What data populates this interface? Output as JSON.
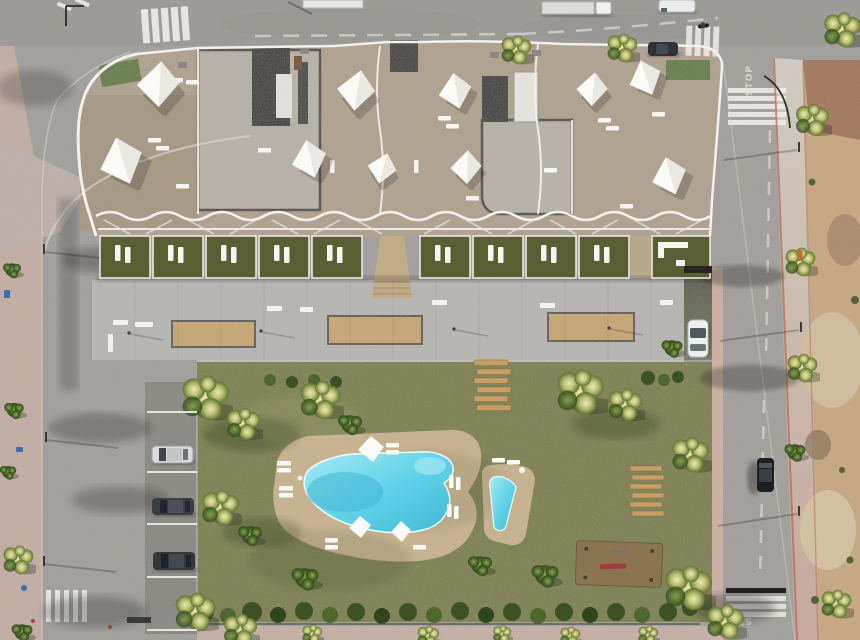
{
  "scene": {
    "type": "aerial-architectural-render",
    "description": "Top-down 3D render of a new-build apartment complex: white wavy-balcony building with roof terraces and shade sails, private ground-floor garden terraces, a grey communal plaza with sand planters, a large lawn garden with free-form pool and kids pool, street parking, surrounding roads, pink sidewalks and an empty dirt plot.",
    "time_of_day": "daytime",
    "road_markings": {
      "stop_top": "STOP",
      "stop_bottom": "STOP"
    },
    "counts": {
      "shade_sails": 10,
      "terrace_gardens": 10,
      "plaza_planters": 3,
      "street_parked_cars": 3,
      "driveway_cars": 1,
      "moving_vehicles": 5,
      "pools": 2,
      "wooden_lounger_decks": 2
    },
    "palette": {
      "asphalt": "#a19f9b",
      "asphalt_dark": "#87857f",
      "sidewalk_pink": "#c6aea4",
      "dirt": "#c9a87c",
      "dirt_red": "#9c6a4b",
      "lawn": "#787c40",
      "terrace_grass": "#5a5f33",
      "hedge": "#3f5526",
      "pool_water": "#63d2e8",
      "pool_deck": "#cbb48c",
      "roof_beige": "#b1a18d",
      "roof_gravel": "#b9b3a9",
      "roof_dark": "#2f2e2b",
      "white_trim": "#f2f1ee",
      "planter_sand": "#c9a76e"
    }
  }
}
